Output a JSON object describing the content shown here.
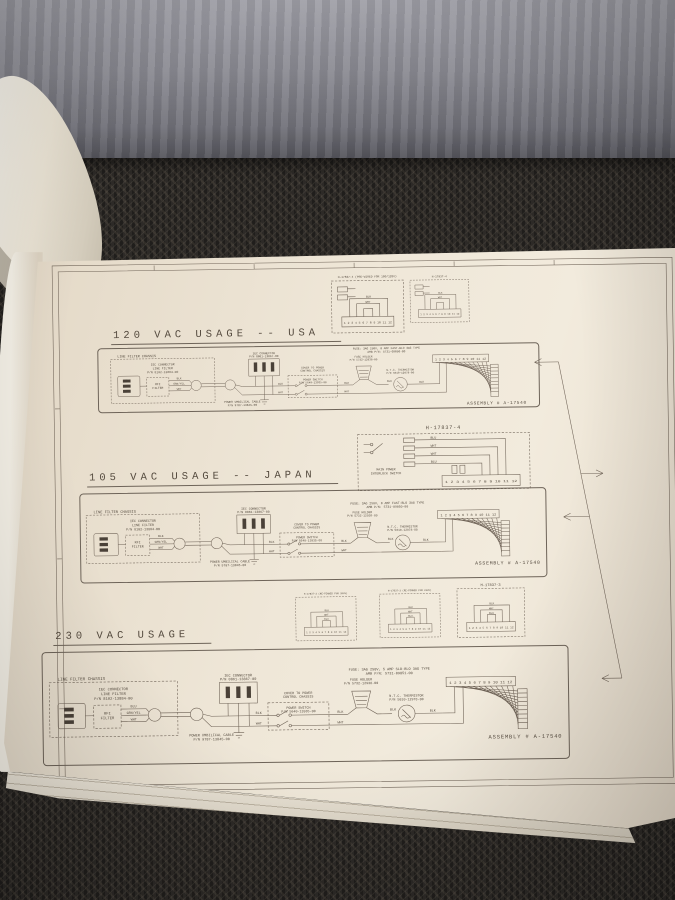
{
  "scene": {
    "description": "Photograph of a printed service-manual wiring-schematic page lying on dark carpet with a grey fabric backdrop; previous pages curled at left",
    "colors": {
      "paper": "#ece2d3",
      "ink": "#5a5045",
      "carpet": "#2d2a27",
      "fabric": "#8f8f97"
    }
  },
  "sections": [
    {
      "title": "120 VAC USAGE -- USA",
      "w_top": "BLK",
      "fuse1": "FUSE: 3AG 250V, 8 AMP FAST-BLO 3AG TYPE",
      "fuse2": "AMB P/N: 5731-09850-00",
      "assembly": "ASSEMBLY # A-17540"
    },
    {
      "title": "105 VAC USAGE -- JAPAN",
      "w_top": "BLK",
      "fuse1": "FUSE: 3AG 250V, 8 AMP FAST-BLO 3AG TYPE",
      "fuse2": "AMB P/N: 5731-09850-00",
      "assembly": "ASSEMBLY # A-17540"
    },
    {
      "title": "230 VAC USAGE",
      "w_top": "BLU",
      "fuse1": "FUSE: 3AG 250V, 5 AMP SLO-BLO 3AG TYPE",
      "fuse2": "AMB P/N: 5731-09851-00",
      "assembly": "ASSEMBLY # A-17540"
    }
  ],
  "sch": {
    "lfc": "LINE FILTER CHASSIS",
    "iec1a": "IEC CONNECTOR",
    "iec1b": "LINE FILTER",
    "iec1c": "P/N 8102-13884-00",
    "rfi1": "RFI",
    "rfi2": "FILTER",
    "gy": "GRN/YEL",
    "wht": "WHT",
    "blk": "BLK",
    "umb1": "POWER UMBILICAL CABLE",
    "umb2": "P/N 9787-13845-00",
    "iec2a": "IEC CONNECTOR",
    "iec2b": "P/N 0861-13867-00",
    "cov1": "COVER TO POWER",
    "cov2": "CONTROL CHASSIS",
    "sw1": "POWER SWITCH",
    "sw2": "P/N 5640-13935-00",
    "fh1": "FUSE HOLDER",
    "fh2": "P/N 5732-12938-00",
    "th1": "N.T.C. THERMISTOR",
    "th2": "P/N 5010-12978-00",
    "terminals": "1 2 3 4 5 6 7 8 9 10 11 12"
  },
  "jb": {
    "top": [
      {
        "title": "H-17837-4 (PRE-WIRED FOR 100/120V)"
      },
      {
        "title": "H-17837-4"
      }
    ],
    "mid": {
      "title": "H-17837-4",
      "sw1": "MAIN POWER",
      "sw2": "INTERLOCK SWITCH",
      "w1": "BLU",
      "w2": "WHT",
      "w3": "WHT",
      "w4": "BLU"
    },
    "bottom": [
      {
        "title": "H-17837-3 (RE-PINNED FOR 200V)"
      },
      {
        "title": "H-17837-3 (RE-PINNED FOR 220V)"
      },
      {
        "title": "H-17837-3"
      }
    ],
    "blk": "BLK",
    "wht": "WHT",
    "blu": "BLU"
  }
}
